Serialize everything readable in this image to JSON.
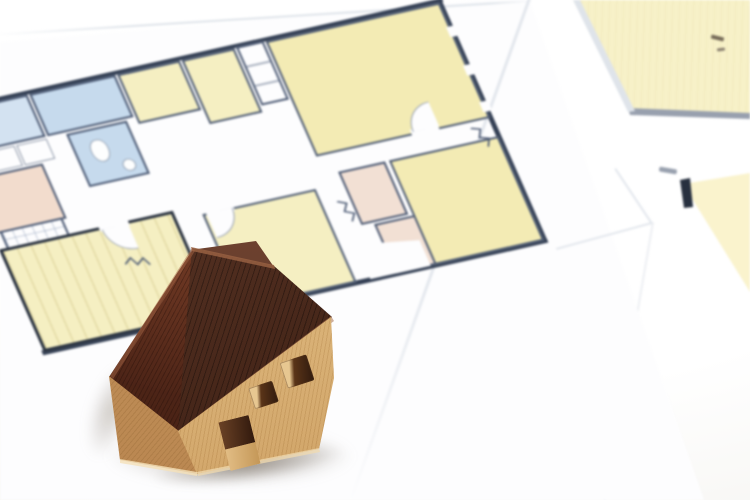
{
  "meta": {
    "kind": "photograph",
    "description": "Close-up photo of a miniature wooden toy house with a dark reddish-brown gabled roof and light beech-wood body (two square window holes and a door notch on the front wall), standing on printed architectural floor-plan sheets lying on a white surface. The main floor plan is tilted and shows pale-yellow rooms, light-blue bathroom rooms, salmon-pink rooms, a tiled entry, a wood-striped room with thick walls, white closets and door swing arcs. A second plan sheet peeks in at the top-right corner."
  },
  "scene": {
    "background": {
      "label": "white tabletop"
    },
    "main_sheet": {
      "label": "main floor-plan sheet",
      "rooms": [
        {
          "id": "blue-room-left",
          "desc": "light blue room, upper left",
          "fill": "room_blue"
        },
        {
          "id": "blue-room-mid",
          "desc": "light blue room beside it",
          "fill": "room_blue2"
        },
        {
          "id": "bathroom",
          "desc": "blue room with toilet and sink fixtures",
          "fill": "room_blue2"
        },
        {
          "id": "pink-room-left",
          "desc": "salmon room on left edge",
          "fill": "room_pink"
        },
        {
          "id": "tiled-entry",
          "desc": "white entry with tile grid",
          "fill": "paper"
        },
        {
          "id": "striped-room",
          "desc": "yellow room with wood-floor stripes and thick dark border, bottom left",
          "fill": "room_yellow"
        },
        {
          "id": "yellow-room-1",
          "desc": "yellow room, top middle",
          "fill": "room_yellow"
        },
        {
          "id": "yellow-room-2",
          "desc": "yellow room, top middle right",
          "fill": "room_yellow"
        },
        {
          "id": "closet-shelves",
          "desc": "white closet with shelf lines",
          "fill": "paper"
        },
        {
          "id": "living-room",
          "desc": "large yellow room, top right",
          "fill": "room_yellow2"
        },
        {
          "id": "center-yellow-room",
          "desc": "yellow room, center",
          "fill": "room_yellow"
        },
        {
          "id": "pink-room-1",
          "desc": "small salmon room, center right",
          "fill": "room_pink2"
        },
        {
          "id": "pink-room-2",
          "desc": "small salmon room below it",
          "fill": "room_pink2"
        },
        {
          "id": "yellow-room-right",
          "desc": "yellow room, lower right",
          "fill": "room_yellow2"
        }
      ],
      "symbols": [
        "door swing arcs",
        "zigzag break marks",
        "wall lines",
        "closet bumps"
      ]
    },
    "secondary_sheet": {
      "label": "second floor-plan sheet, top right corner",
      "regions": [
        "pale yellow room with gray wall line",
        "yellow wedge at right edge with black wall stub",
        "tiny dark plan marks"
      ]
    },
    "house": {
      "label": "miniature wooden house model",
      "parts": [
        "dark red-brown roof gable face",
        "dark red-brown roof front slope",
        "roof ridge",
        "light wood left wall",
        "light wood front wall",
        "large square window hole",
        "small square window hole",
        "door notch",
        "soft cast shadow"
      ]
    }
  },
  "palette": {
    "table_light": "#ffffff",
    "table_shade": "#f3f2ee",
    "paper": "#fdfdfe",
    "paper_edge": "#dfe4ea",
    "paper_edge2": "#e3e7ed",
    "paper_edge_faint": "#edeff3",
    "wall_dark": "#333f54",
    "wall_mid": "#4c5a74",
    "wall_black": "#27303f",
    "wall_soft": "#98a0ae",
    "mark_dark": "#756a58",
    "mark_soft": "#8a8070",
    "room_yellow": "#f5efc2",
    "room_yellow2": "#f3ebb4",
    "room_yellow_pale": "#f7f1c8",
    "room_yellow_pale2": "#faf3cd",
    "room_blue": "#d3e2f1",
    "room_blue2": "#c6daed",
    "room_pink": "#f2dccd",
    "room_pink2": "#f2e0d4",
    "roof_dark": "#4e2718",
    "roof_mid": "#5d2d1d",
    "roof_light": "#7a5440",
    "wood_light": "#e6c189",
    "wood_mid": "#cfa068",
    "wood_mid2": "#d9b176",
    "wood_dark": "#b8854f",
    "wood_dark2": "#c9995c",
    "window_hole": "#2f1a0e",
    "window_mid": "#5a3418",
    "window_lip": "#e7c791",
    "door_dark": "#31190d",
    "door_dark2": "#6b4226",
    "door_light": "#e2bd85",
    "door_light2": "#c49757"
  }
}
